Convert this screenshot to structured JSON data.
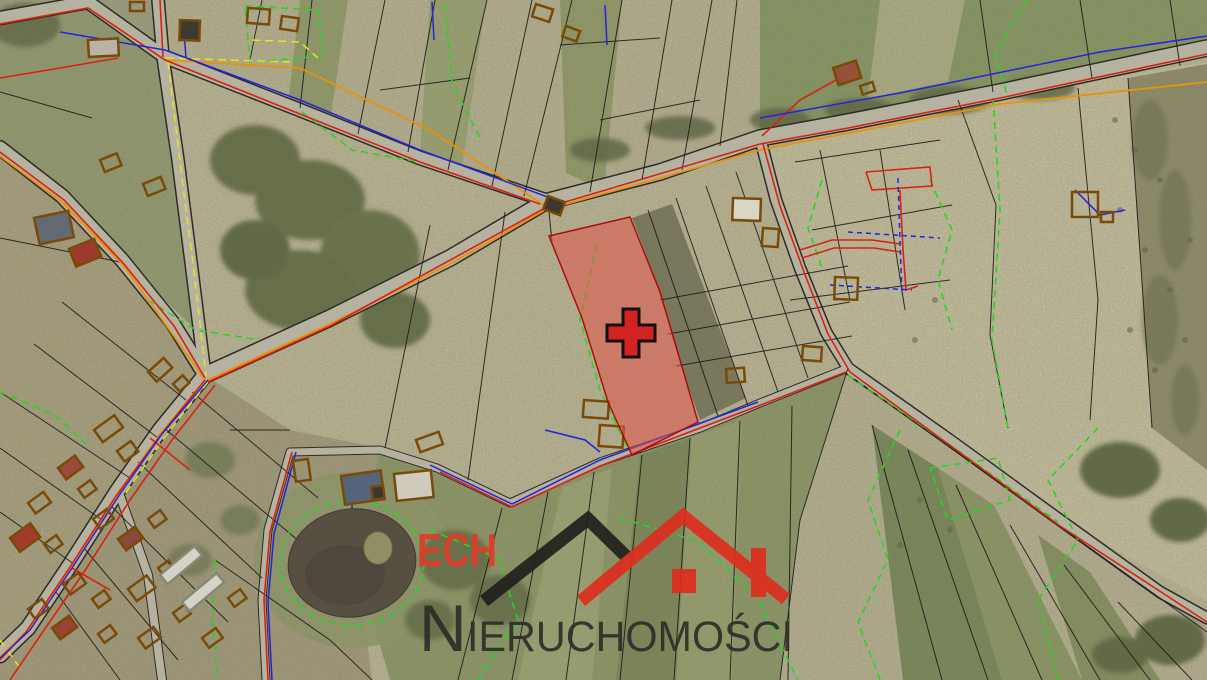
{
  "watermark": {
    "brand": "ECH",
    "name_initial": "N",
    "name_rest": "IERUCHOMOŚCI",
    "full_name": "NIERUCHOMOŚCI",
    "colors": {
      "brand_red": "#e23a28",
      "roof_left_black": "#1f1d1b",
      "roof_right_red": "#e02b1d",
      "name_charcoal": "#2d2b27"
    }
  },
  "map": {
    "type": "aerial-cadastral-map",
    "highlight": {
      "fill_color": "#e4544a",
      "border_color": "#aa0000",
      "polygon_points": "549,236 630,217 660,292 685,377 698,422 632,455 608,402 582,318",
      "marker": {
        "shape": "plus-cross",
        "color": "#d32222",
        "outline": "#111111",
        "transform": "translate(631,333)"
      }
    },
    "layer_colors": {
      "parcel_boundary": "#1c1c1c",
      "utility_green": "#27d427",
      "utility_blue": "#2424dd",
      "utility_red": "#d92211",
      "utility_orange": "#e8920a",
      "utility_yellow": "#e8e418",
      "building_outline": "#7a4a08",
      "road_fill": "#b6b2a0",
      "water": "#574f42"
    }
  }
}
